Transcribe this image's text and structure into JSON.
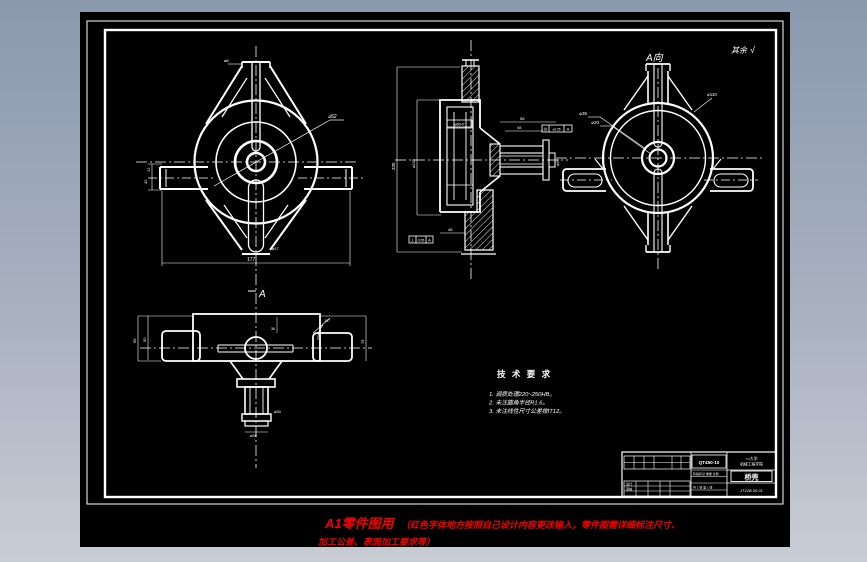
{
  "colors": {
    "bg_top": "#8a99ae",
    "bg_bottom": "#c8ccd5",
    "sheet": "#000000",
    "line": "#ffffff",
    "red": "#f40000"
  },
  "labels": {
    "view_a": "A向",
    "arrow_a": "A",
    "surface_note": "其余",
    "roughness_icon": "√"
  },
  "tech": {
    "title": "技 术 要 求",
    "l1": "1. 调质处理220~250HB。",
    "l2": "2. 未注圆角半径R1.6。",
    "l3": "3. 未注线性尺寸公差按IT12。"
  },
  "dims": {
    "v1_width": "177",
    "v1_t1": "12",
    "v1_t2": "42",
    "v1_dia": "⌀52",
    "v1_top": "⌀8",
    "v1_foot": "⌀17",
    "v2_len": "335",
    "v2_dia": "⌀245",
    "v2_bot": "48",
    "v2_top1": "45",
    "v2_top2": "58",
    "v2_shaft": "⌀30",
    "v2_bore": "⌀60H7",
    "gdt1": {
      "sym": "◎",
      "tol": "⌀0.05",
      "datum": "A"
    },
    "gdt2": {
      "sym": "⊥",
      "tol": "0.05",
      "datum": "A"
    },
    "v3_d1": "⌀35",
    "v3_d2": "⌀20",
    "v3_d3": "⌀110",
    "v4_w1": "95",
    "v4_w2": "50",
    "v4_h1": "75",
    "v4_ang": "15°",
    "v4_d1": "⌀30",
    "v4_d2": "⌀36",
    "v4_d3": "36"
  },
  "title_block": {
    "material": "QT450-10",
    "org1": "××大学",
    "org2": "机械工程学院",
    "part_name": "桥壳",
    "drawing_no": "JT12B.00.01",
    "sig1": "设计",
    "sig2": "审核",
    "row1": "阶段标记  重量  比例",
    "row2": "共 1 张  第 1 张"
  },
  "footer": {
    "title": "A1零件图用",
    "note1": "（红色字体地方按照自己设计内容更改输入，零件图需详细标注尺寸、",
    "note2": "加工公差、表面加工要求等）"
  }
}
